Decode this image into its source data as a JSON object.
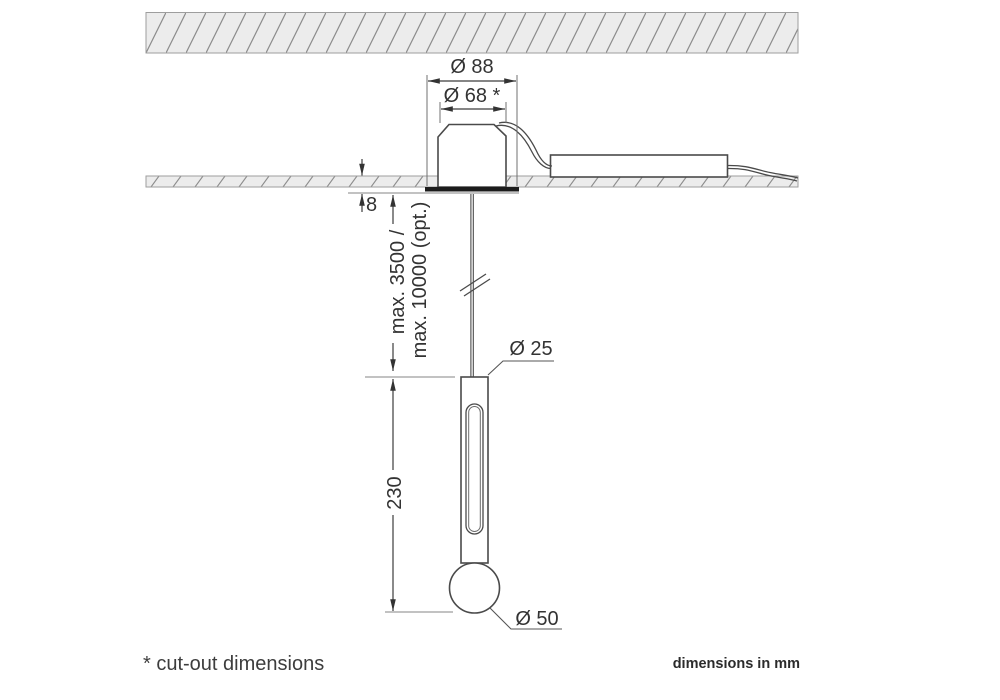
{
  "drawing": {
    "dimensions": {
      "housing_outer": "Ø 88",
      "cutout": "Ø 68 *",
      "recess_depth": "8",
      "suspension_max": "max. 3500 /",
      "suspension_max_opt": "max. 10000 (opt.)",
      "body_length": "230",
      "tube_diameter": "Ø 25",
      "sphere_diameter": "Ø 50"
    }
  },
  "footer": {
    "footnote": "* cut-out dimensions",
    "units_note": "dimensions in mm"
  },
  "colors": {
    "object_line": "#4a4a4a",
    "dimension_line": "#3c3c3c",
    "hatch_fill": "#ececec",
    "hatch_stroke": "#8c8c8c",
    "flange": "#1c1c1c",
    "text": "#333333"
  }
}
